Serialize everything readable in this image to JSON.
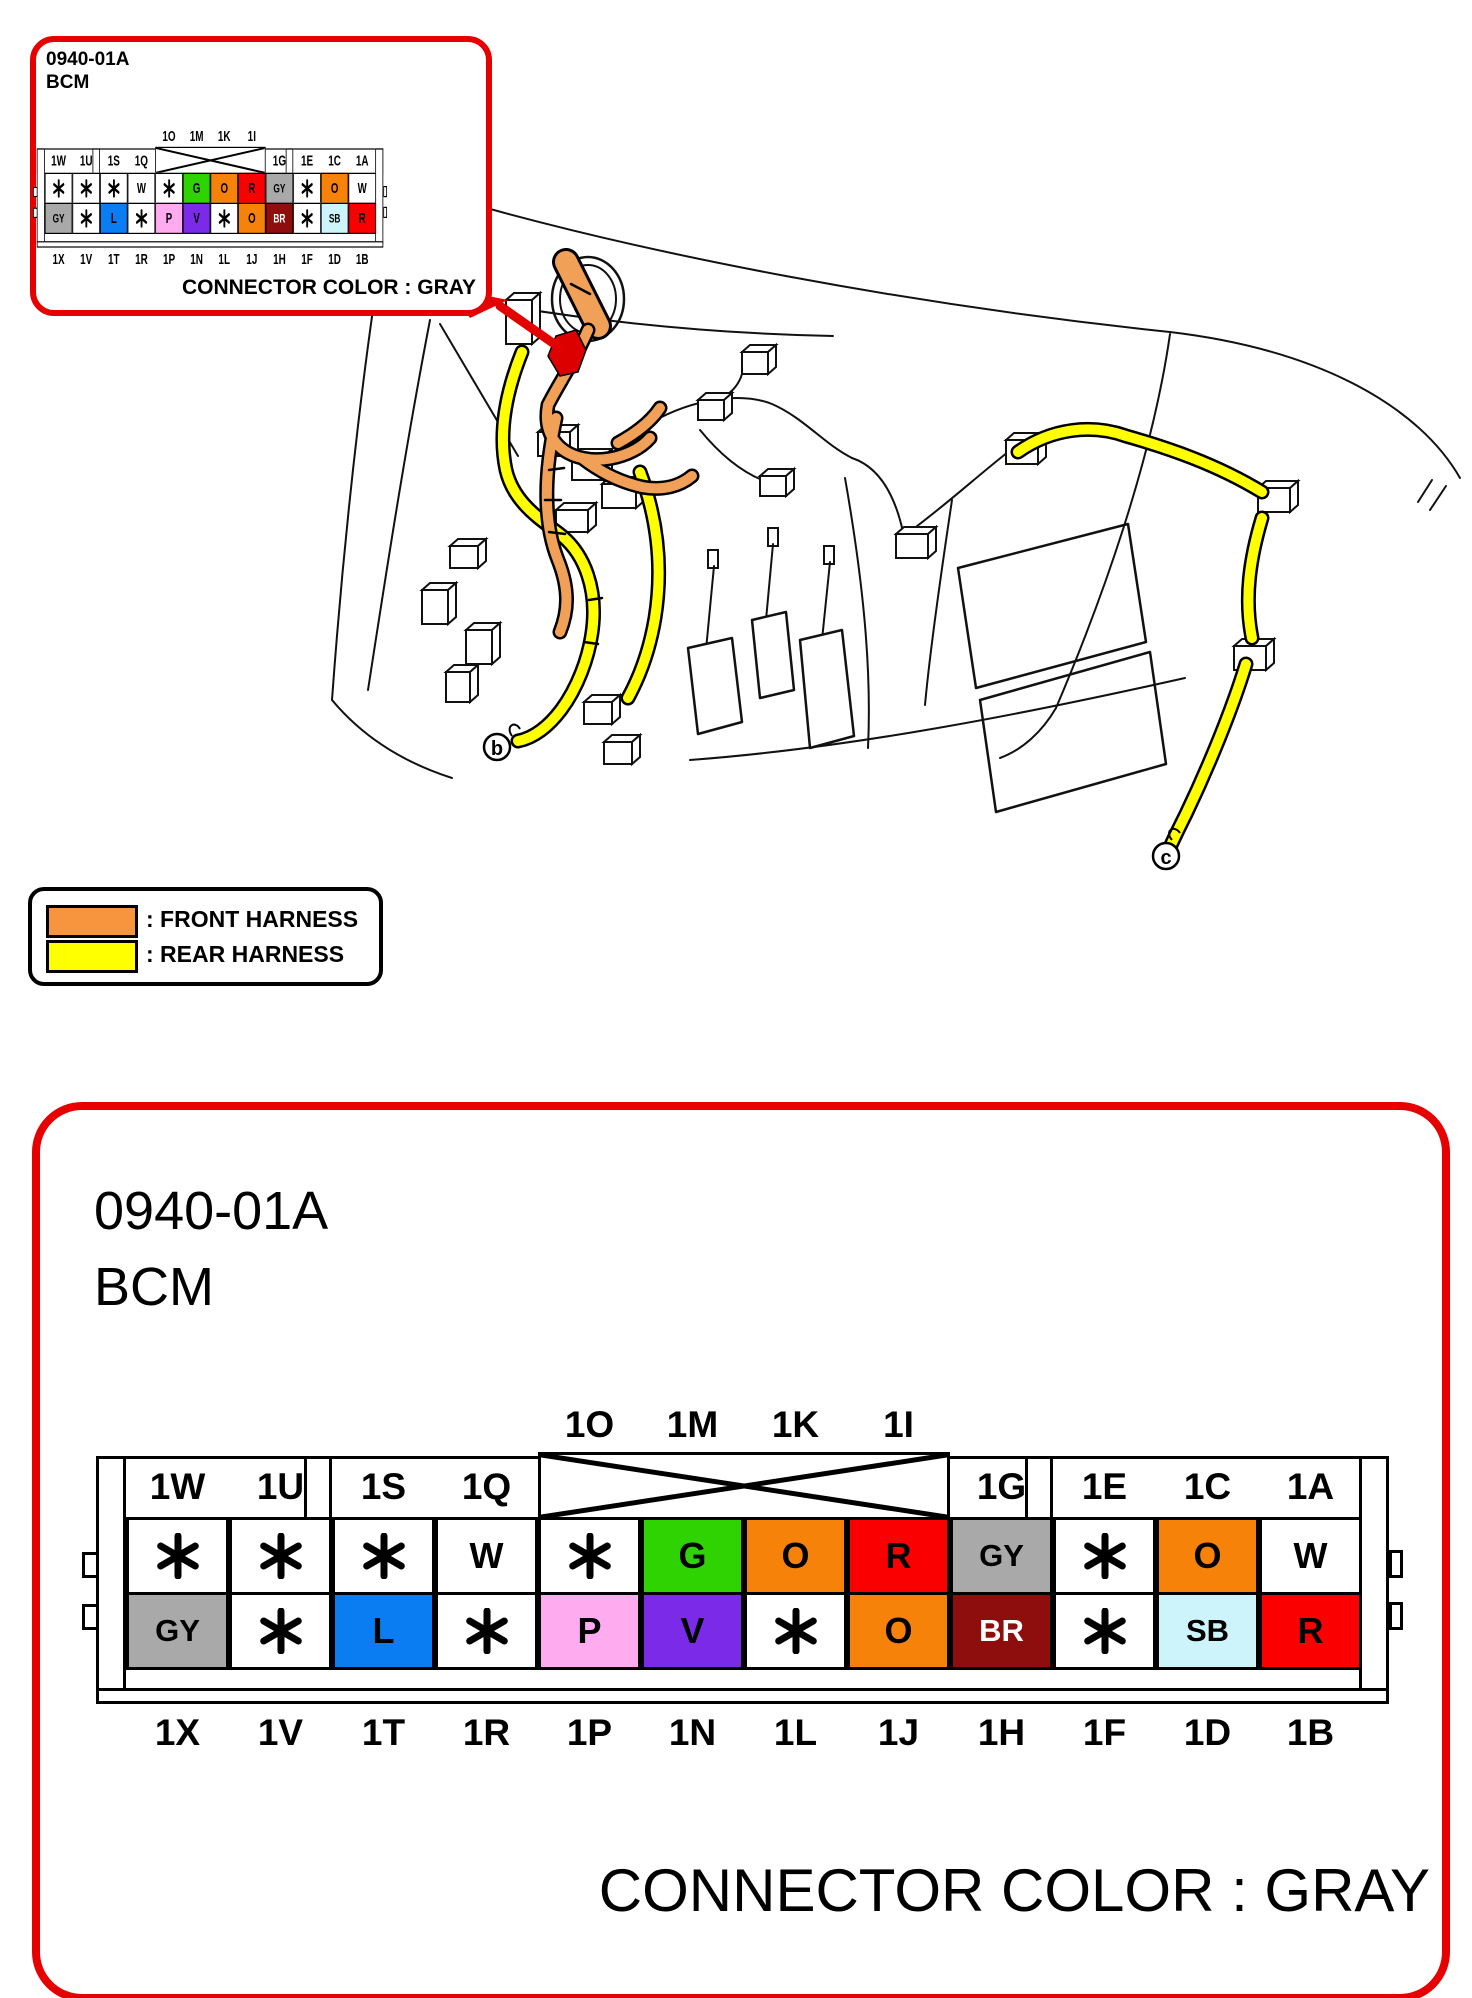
{
  "inset": {
    "code": "0940-01A",
    "name": "BCM",
    "note": "CONNECTOR COLOR : GRAY"
  },
  "detail_panel": {
    "code": "0940-01A",
    "name": "BCM",
    "note": "CONNECTOR COLOR : GRAY"
  },
  "legend": {
    "items": [
      {
        "label": ": FRONT HARNESS",
        "color": "#F6953E"
      },
      {
        "label": ": REAR HARNESS",
        "color": "#FFFF00"
      }
    ]
  },
  "drawing": {
    "callout_b": "b",
    "callout_c": "c",
    "front_harness_color": "#F0A057",
    "rear_harness_color": "#FFFF00",
    "highlight_color": "#DD0000",
    "callout_arrow_color": "#E30000"
  },
  "connector": {
    "crossed_slots": [
      4,
      5,
      6,
      7
    ],
    "columns": [
      {
        "top": "1W",
        "bottom": "1X",
        "row1": {
          "code": "*",
          "bg": "#FFFFFF"
        },
        "row2": {
          "code": "GY",
          "bg": "#A9A9A9"
        }
      },
      {
        "top": "1U",
        "bottom": "1V",
        "row1": {
          "code": "*",
          "bg": "#FFFFFF"
        },
        "row2": {
          "code": "*",
          "bg": "#FFFFFF"
        }
      },
      {
        "top": "1S",
        "bottom": "1T",
        "row1": {
          "code": "*",
          "bg": "#FFFFFF"
        },
        "row2": {
          "code": "L",
          "bg": "#0A7DF2"
        }
      },
      {
        "top": "1Q",
        "bottom": "1R",
        "row1": {
          "code": "W",
          "bg": "#FFFFFF"
        },
        "row2": {
          "code": "*",
          "bg": "#FFFFFF"
        }
      },
      {
        "top": "1O",
        "bottom": "1P",
        "row1": {
          "code": "*",
          "bg": "#FFFFFF"
        },
        "row2": {
          "code": "P",
          "bg": "#FFABF0"
        }
      },
      {
        "top": "1M",
        "bottom": "1N",
        "row1": {
          "code": "G",
          "bg": "#2ED301"
        },
        "row2": {
          "code": "V",
          "bg": "#7B2BE8"
        }
      },
      {
        "top": "1K",
        "bottom": "1L",
        "row1": {
          "code": "O",
          "bg": "#F6820A"
        },
        "row2": {
          "code": "*",
          "bg": "#FFFFFF"
        }
      },
      {
        "top": "1I",
        "bottom": "1J",
        "row1": {
          "code": "R",
          "bg": "#FA0000"
        },
        "row2": {
          "code": "O",
          "bg": "#F6820A"
        }
      },
      {
        "top": "1G",
        "bottom": "1H",
        "row1": {
          "code": "GY",
          "bg": "#A9A9A9"
        },
        "row2": {
          "code": "BR",
          "bg": "#8E0D0D",
          "fg": "#FFFFFF"
        }
      },
      {
        "top": "1E",
        "bottom": "1F",
        "row1": {
          "code": "*",
          "bg": "#FFFFFF"
        },
        "row2": {
          "code": "*",
          "bg": "#FFFFFF"
        }
      },
      {
        "top": "1C",
        "bottom": "1D",
        "row1": {
          "code": "O",
          "bg": "#F6820A"
        },
        "row2": {
          "code": "SB",
          "bg": "#CDF4FB"
        }
      },
      {
        "top": "1A",
        "bottom": "1B",
        "row1": {
          "code": "W",
          "bg": "#FFFFFF"
        },
        "row2": {
          "code": "R",
          "bg": "#FA0000"
        }
      }
    ]
  }
}
